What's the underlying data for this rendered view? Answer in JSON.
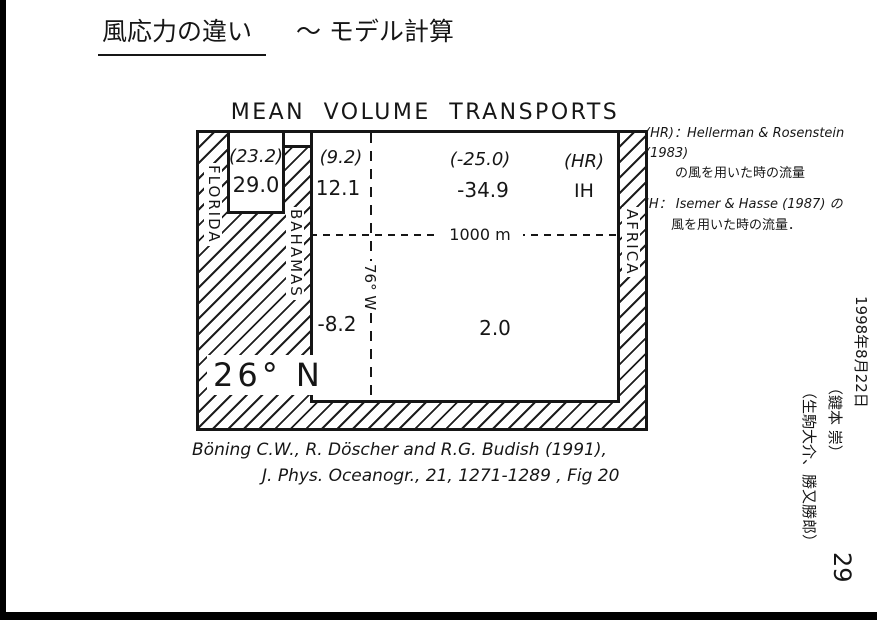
{
  "page": {
    "title_main": "風応力の違い",
    "title_suffix": "～ モデル計算",
    "page_number": "29"
  },
  "figure": {
    "title": "MEAN VOLUME TRANSPORTS",
    "land_labels": {
      "left": "FLORIDA",
      "middle": "BAHAMAS",
      "right": "AFRICA"
    },
    "latitude_label": "26° N",
    "longitude_line_label": "76° W",
    "depth_line_label": "1000 m",
    "transports": {
      "florida_strait_hr": "(23.2)",
      "florida_strait_ih": "29.0",
      "upper_west_hr": "(9.2)",
      "upper_west_ih": "12.1",
      "upper_east_hr": "(-25.0)",
      "upper_east_ih": "-34.9",
      "legend_hr": "(HR)",
      "legend_ih": "IH",
      "deep_west": "-8.2",
      "deep_east": "2.0"
    }
  },
  "side_note": {
    "hr_line1": "(HR)：Hellerman & Rosenstein (1983)",
    "hr_line2": "の風を用いた時の流量",
    "ih_line1": "IH： Isemer & Hasse (1987) の",
    "ih_line2": "風を用いた時の流量．"
  },
  "citation": {
    "line1": "Böning C.W., R. Döscher and R.G. Budish (1991),",
    "line2": "J. Phys. Oceanogr., 21, 1271-1289 , Fig 20"
  },
  "margin_note": {
    "date": "1998年8月22日",
    "name1": "（鍵本 崇）",
    "name2": "（生駒大介、勝又勝郎）"
  }
}
